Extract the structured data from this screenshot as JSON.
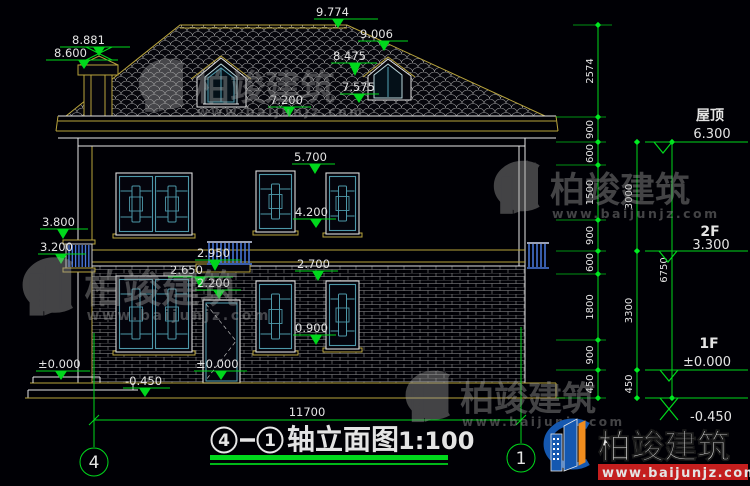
{
  "drawing": {
    "title": {
      "axis_from": "4",
      "axis_to": "1",
      "name": "轴立面图",
      "scale": "1:100"
    },
    "axis_grid": {
      "left": "4",
      "right": "1"
    },
    "overall_width_dim": "11700",
    "elevation_markers": [
      {
        "id": "ridge",
        "value": "9.774"
      },
      {
        "id": "dormer2_peak",
        "value": "9.006"
      },
      {
        "id": "chimney_top",
        "value": "8.881"
      },
      {
        "id": "chimney_cap",
        "value": "8.600"
      },
      {
        "id": "dormer_eave",
        "value": "8.475"
      },
      {
        "id": "dormer_sill",
        "value": "7.575"
      },
      {
        "id": "eave",
        "value": "7.200"
      },
      {
        "id": "win2f_top",
        "value": "5.700"
      },
      {
        "id": "win2f_sill",
        "value": "4.200"
      },
      {
        "id": "vent_top",
        "value": "3.800"
      },
      {
        "id": "vent_sill",
        "value": "3.200"
      },
      {
        "id": "railing_top",
        "value": "2.950"
      },
      {
        "id": "canopy",
        "value": "2.650"
      },
      {
        "id": "door_top",
        "value": "2.200"
      },
      {
        "id": "win1f_top",
        "value": "2.700"
      },
      {
        "id": "win1f_sill",
        "value": "0.900"
      },
      {
        "id": "floor_left",
        "value": "±0.000"
      },
      {
        "id": "ground_left",
        "value": "-0.450"
      },
      {
        "id": "floor_door",
        "value": "±0.000"
      }
    ],
    "dim_chain_inner": [
      "2574",
      "900",
      "600",
      "1500",
      "900",
      "600",
      "1800",
      "900",
      "450"
    ],
    "dim_chain_mid": [
      "3000",
      "3300",
      "450"
    ],
    "dim_chain_outer": [
      "6750"
    ],
    "levels": [
      {
        "name": "屋顶",
        "value": "6.300"
      },
      {
        "name": "2F",
        "value": "3.300"
      },
      {
        "name": "1F",
        "value": "±0.000"
      },
      {
        "name": "",
        "value": "-0.450"
      }
    ],
    "watermark": {
      "brand": "柏竣建筑",
      "url": "www.baijunjz.com"
    },
    "logo": {
      "brand": "柏竣建筑",
      "url": "www.baijunjz.com"
    }
  },
  "colors": {
    "background": "#000005",
    "cad_yellow": "#b9a43c",
    "cad_white": "#e6e6e6",
    "dim_green": "#00d81c",
    "window_teal": "#4d97a8",
    "railing_blue": "#4a7ae0",
    "logo_blue": "#1558b0",
    "logo_orange": "#f08c1e",
    "logo_red": "#c41e1e"
  }
}
